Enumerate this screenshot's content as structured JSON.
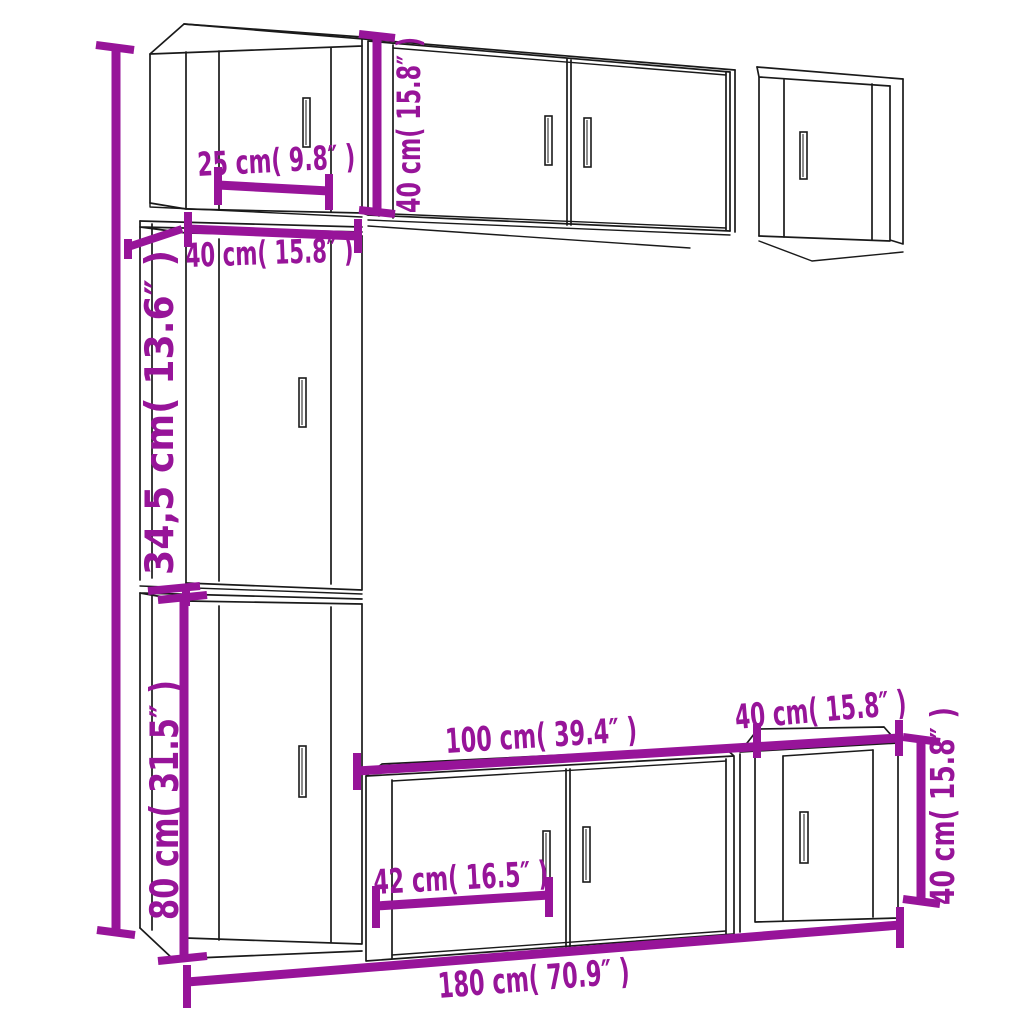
{
  "page": {
    "title": "TV cabinet set dimension diagram",
    "background": "#ffffff"
  },
  "style": {
    "outline_color": "#1a1a1a",
    "dimension_color": "#971499"
  },
  "diagram": {
    "type": "furniture-dimension-diagram",
    "subject": "7-piece wall-mounted TV cabinet set line drawing with dimension callouts",
    "units": [
      "cm",
      "inches"
    ],
    "labels": {
      "top_cabinet_door_width": "25 cm( 9.8″ )",
      "top_cabinet_height": "40 cm( 15.8″ )",
      "left_column_width": "40 cm( 15.8″ )",
      "middle_left_cabinet_height": "34,5 cm( 13.6″ )",
      "bottom_left_cabinet_height": "80 cm( 31.5″ )",
      "bottom_wide_cabinet_width": "100 cm( 39.4″ )",
      "bottom_right_cabinet_width": "40 cm( 15.8″ )",
      "bottom_door_width": "42 cm( 16.5″ )",
      "bottom_right_cabinet_height": "40 cm( 15.8″ )",
      "total_width": "180 cm( 70.9″ )"
    }
  }
}
